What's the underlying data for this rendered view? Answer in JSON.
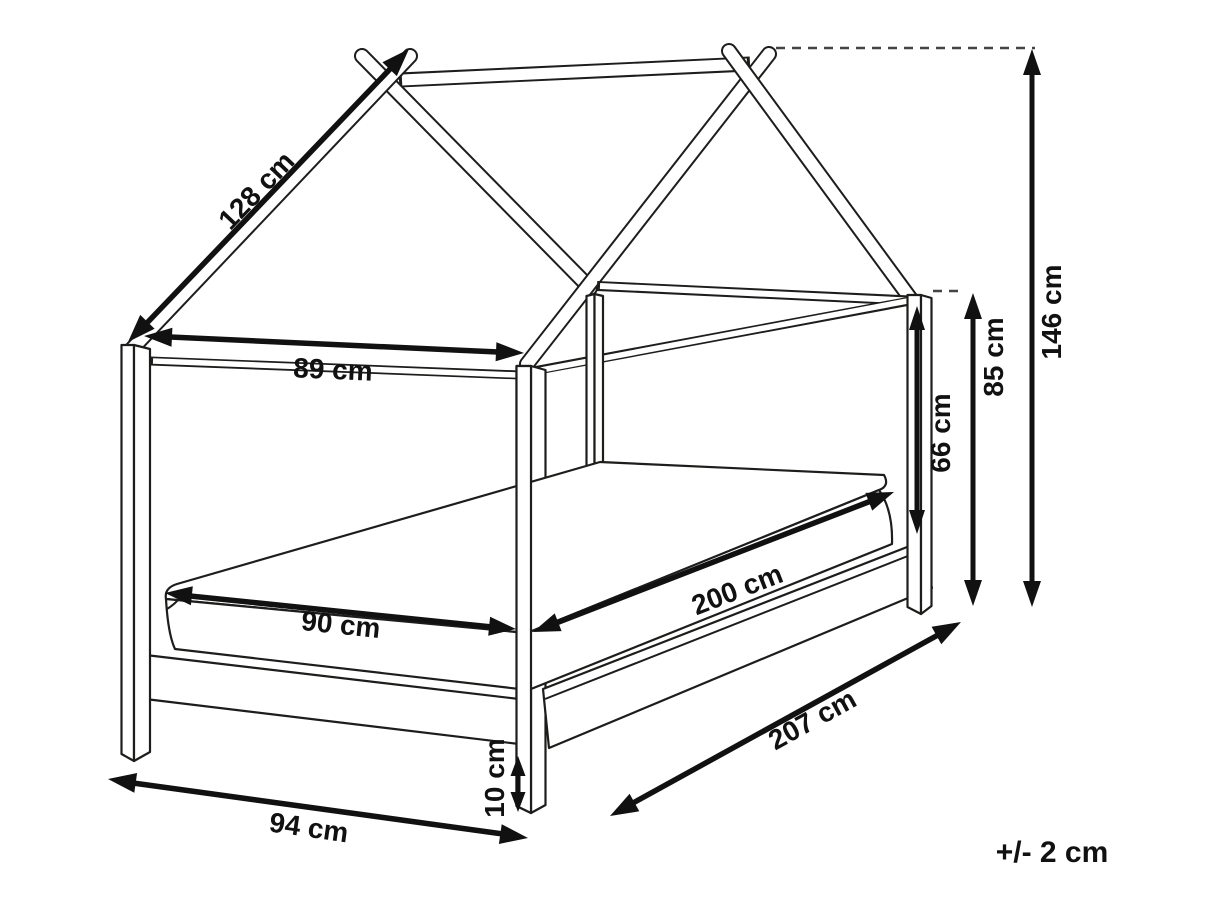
{
  "figure": {
    "type": "technical line drawing",
    "subject": "kids house-frame canopy bed, perspective view with dimension arrows",
    "background_color": "#ffffff",
    "line_color": "#1d1d1b",
    "dimension_color": "#111111"
  },
  "labels": {
    "roof_slope": "128 cm",
    "frame_inner_width": "89 cm",
    "total_height": "146 cm",
    "side_height": "85 cm",
    "canopy_opening_height": "66 cm",
    "mattress_length": "200 cm",
    "mattress_width": "90 cm",
    "total_length": "207 cm",
    "total_width": "94 cm",
    "base_height": "10 cm",
    "tolerance": "+/- 2 cm"
  }
}
